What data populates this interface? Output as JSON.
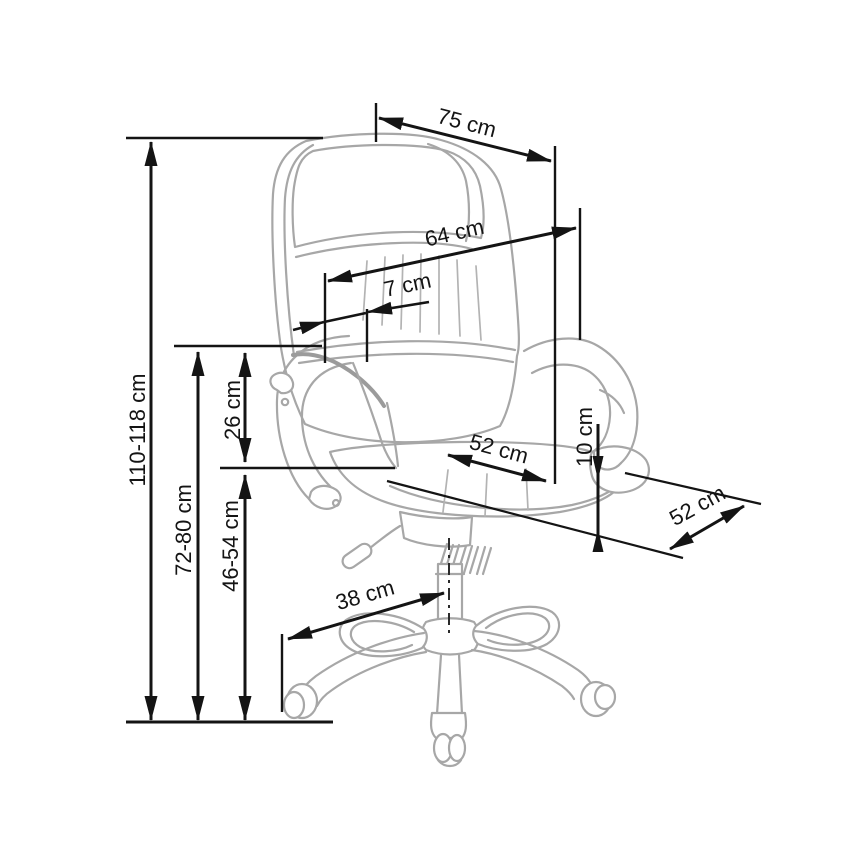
{
  "diagram": {
    "subject": "office swivel chair dimension drawing",
    "unit": "cm",
    "labels": {
      "overall_height": "110-118 cm",
      "floor_to_armrest_height": "72-80 cm",
      "seat_height": "46-54 cm",
      "armrest_above_seat_height": "26 cm",
      "top_width": "75 cm",
      "backrest_width": "64 cm",
      "headrest_offset": "7 cm",
      "seat_width": "52 cm",
      "seat_depth": "52 cm",
      "seat_cushion_thickness": "10 cm",
      "base_leg_radius": "38 cm"
    },
    "colors": {
      "dimension_lines": "#141414",
      "chair_outline": "#a7a7a7",
      "background": "#ffffff"
    }
  }
}
